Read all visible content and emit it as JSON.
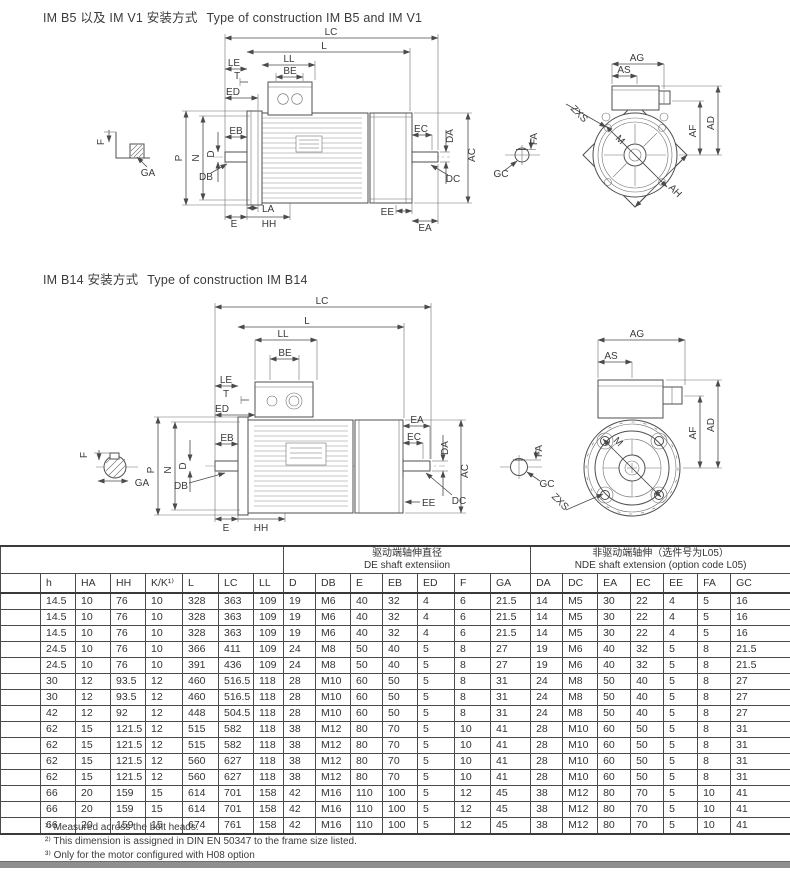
{
  "sections": [
    {
      "title_zh": "IM B5 以及 IM V1 安装方式",
      "title_en": "Type of construction IM B5 and IM V1"
    },
    {
      "title_zh": "IM B14 安装方式",
      "title_en": "Type of construction IM B14"
    }
  ],
  "dims": {
    "LC": "LC",
    "L": "L",
    "LL": "LL",
    "BE": "BE",
    "LE": "LE",
    "T": "T",
    "ED": "ED",
    "EB": "EB",
    "D": "D",
    "DB": "DB",
    "P": "P",
    "N": "N",
    "F": "F",
    "GA": "GA",
    "LA": "LA",
    "E": "E",
    "HH": "HH",
    "EC": "EC",
    "EA": "EA",
    "DA": "DA",
    "AC": "AC",
    "DC": "DC",
    "EE": "EE",
    "FA": "FA",
    "GC": "GC",
    "AG": "AG",
    "AS": "AS",
    "M": "M",
    "AF": "AF",
    "AD": "AD",
    "AH": "AH",
    "ZXS": "ZXS"
  },
  "table": {
    "groups": {
      "de": {
        "zh": "驱动端轴伸直径",
        "en": "DE shaft extensiion"
      },
      "nde": {
        "zh": "非驱动端轴伸（选件号为L05）",
        "en": "NDE shaft extension  (option code L05)"
      }
    },
    "columns": [
      "",
      "h",
      "HA",
      "HH",
      "K/K¹⁾",
      "L",
      "LC",
      "LL",
      "D",
      "DB",
      "E",
      "EB",
      "ED",
      "F",
      "GA",
      "DA",
      "DC",
      "EA",
      "EC",
      "EE",
      "FA",
      "GC"
    ],
    "rows": [
      [
        "",
        "14.5",
        "10",
        "76",
        "10",
        "328",
        "363",
        "109",
        "19",
        "M6",
        "40",
        "32",
        "4",
        "6",
        "21.5",
        "14",
        "M5",
        "30",
        "22",
        "4",
        "5",
        "16"
      ],
      [
        "",
        "14.5",
        "10",
        "76",
        "10",
        "328",
        "363",
        "109",
        "19",
        "M6",
        "40",
        "32",
        "4",
        "6",
        "21.5",
        "14",
        "M5",
        "30",
        "22",
        "4",
        "5",
        "16"
      ],
      [
        "",
        "14.5",
        "10",
        "76",
        "10",
        "328",
        "363",
        "109",
        "19",
        "M6",
        "40",
        "32",
        "4",
        "6",
        "21.5",
        "14",
        "M5",
        "30",
        "22",
        "4",
        "5",
        "16"
      ],
      [
        "",
        "24.5",
        "10",
        "76",
        "10",
        "366",
        "411",
        "109",
        "24",
        "M8",
        "50",
        "40",
        "5",
        "8",
        "27",
        "19",
        "M6",
        "40",
        "32",
        "5",
        "8",
        "21.5"
      ],
      [
        "",
        "24.5",
        "10",
        "76",
        "10",
        "391",
        "436",
        "109",
        "24",
        "M8",
        "50",
        "40",
        "5",
        "8",
        "27",
        "19",
        "M6",
        "40",
        "32",
        "5",
        "8",
        "21.5"
      ],
      [
        "",
        "30",
        "12",
        "93.5",
        "12",
        "460",
        "516.5",
        "118",
        "28",
        "M10",
        "60",
        "50",
        "5",
        "8",
        "31",
        "24",
        "M8",
        "50",
        "40",
        "5",
        "8",
        "27"
      ],
      [
        "",
        "30",
        "12",
        "93.5",
        "12",
        "460",
        "516.5",
        "118",
        "28",
        "M10",
        "60",
        "50",
        "5",
        "8",
        "31",
        "24",
        "M8",
        "50",
        "40",
        "5",
        "8",
        "27"
      ],
      [
        "",
        "42",
        "12",
        "92",
        "12",
        "448",
        "504.5",
        "118",
        "28",
        "M10",
        "60",
        "50",
        "5",
        "8",
        "31",
        "24",
        "M8",
        "50",
        "40",
        "5",
        "8",
        "27"
      ],
      [
        "",
        "62",
        "15",
        "121.5",
        "12",
        "515",
        "582",
        "118",
        "38",
        "M12",
        "80",
        "70",
        "5",
        "10",
        "41",
        "28",
        "M10",
        "60",
        "50",
        "5",
        "8",
        "31"
      ],
      [
        "",
        "62",
        "15",
        "121.5",
        "12",
        "515",
        "582",
        "118",
        "38",
        "M12",
        "80",
        "70",
        "5",
        "10",
        "41",
        "28",
        "M10",
        "60",
        "50",
        "5",
        "8",
        "31"
      ],
      [
        "",
        "62",
        "15",
        "121.5",
        "12",
        "560",
        "627",
        "118",
        "38",
        "M12",
        "80",
        "70",
        "5",
        "10",
        "41",
        "28",
        "M10",
        "60",
        "50",
        "5",
        "8",
        "31"
      ],
      [
        "",
        "62",
        "15",
        "121.5",
        "12",
        "560",
        "627",
        "118",
        "38",
        "M12",
        "80",
        "70",
        "5",
        "10",
        "41",
        "28",
        "M10",
        "60",
        "50",
        "5",
        "8",
        "31"
      ],
      [
        "",
        "66",
        "20",
        "159",
        "15",
        "614",
        "701",
        "158",
        "42",
        "M16",
        "110",
        "100",
        "5",
        "12",
        "45",
        "38",
        "M12",
        "80",
        "70",
        "5",
        "10",
        "41"
      ],
      [
        "",
        "66",
        "20",
        "159",
        "15",
        "614",
        "701",
        "158",
        "42",
        "M16",
        "110",
        "100",
        "5",
        "12",
        "45",
        "38",
        "M12",
        "80",
        "70",
        "5",
        "10",
        "41"
      ],
      [
        "",
        "66",
        "20",
        "159",
        "15",
        "674",
        "761",
        "158",
        "42",
        "M16",
        "110",
        "100",
        "5",
        "12",
        "45",
        "38",
        "M12",
        "80",
        "70",
        "5",
        "10",
        "41"
      ]
    ]
  },
  "footnotes": [
    "¹⁾ Measured across the bolt heads.",
    "²⁾ This dimension is assigned in DIN EN 50347 to the frame size listed.",
    "³⁾ Only for the motor configured with H08 option"
  ]
}
